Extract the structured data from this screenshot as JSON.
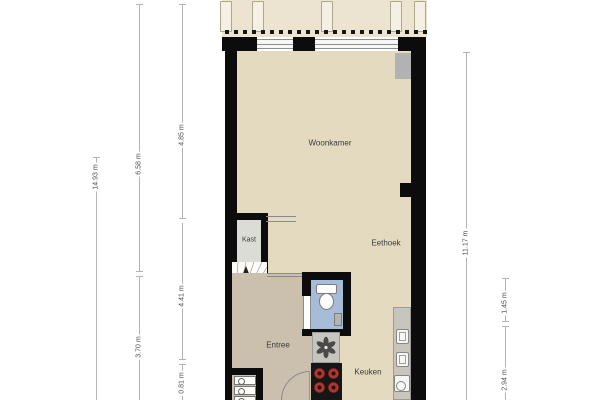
{
  "plan": {
    "rooms": {
      "woonkamer": "Woonkamer",
      "eethoek": "Eethoek",
      "kast": "Kast",
      "entree": "Entree",
      "keuken": "Keuken"
    },
    "dimensions_left": [
      {
        "value": "14.93 m"
      },
      {
        "value": "6.58 m"
      },
      {
        "value": "4.85 m"
      },
      {
        "value": "4.41 m"
      },
      {
        "value": "3.70 m"
      },
      {
        "value": "0.81 m"
      }
    ],
    "dimensions_right": [
      {
        "value": "11.17 m"
      },
      {
        "value": "1.45 m"
      },
      {
        "value": "2.94 m"
      }
    ],
    "colors": {
      "wall": "#0c0c0c",
      "floor_main": "#e3dabf",
      "floor_entree": "#cbc0ae",
      "floor_kast": "#dcdcd6",
      "floor_toilet": "#a6bcd8",
      "terrace": "#ece4d1",
      "counter": "#c6c6bf",
      "burner_red": "#b5342c",
      "dimension_line": "#b3b3b3"
    },
    "icons": {
      "stair_arrow": "up-arrow",
      "toilet": "toilet-top-view",
      "sink_symbol": "six-petal-drain",
      "cooktop": "four-burners",
      "oven": "built-in-oven",
      "microwave": "built-in-microwave",
      "kitchen_sink": "sink-with-basin",
      "washer": "stacked-appliances",
      "entry_door": "door-swing-arc"
    }
  }
}
